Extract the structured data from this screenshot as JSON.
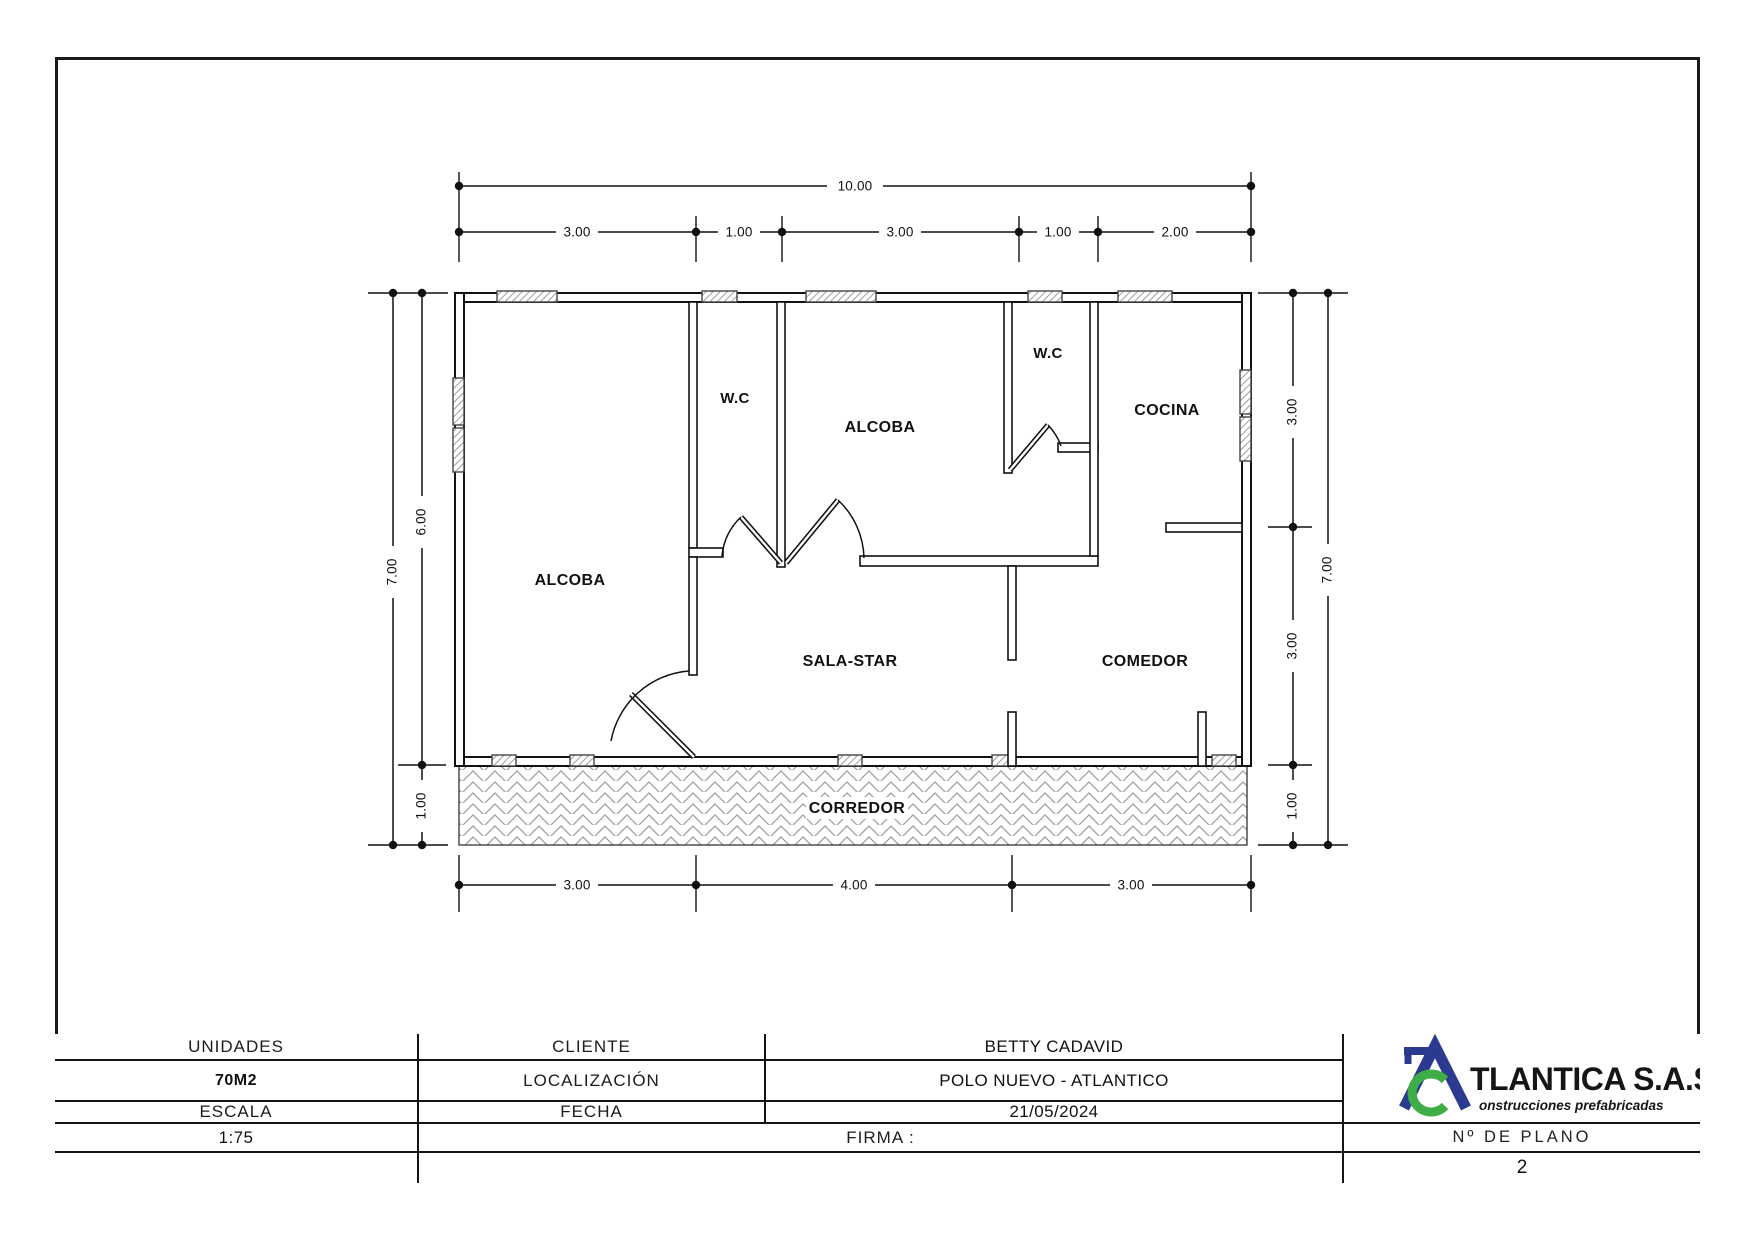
{
  "plan": {
    "rooms": [
      {
        "id": "alcoba-left",
        "label": "ALCOBA"
      },
      {
        "id": "wc-left",
        "label": "W.C"
      },
      {
        "id": "alcoba-center",
        "label": "ALCOBA"
      },
      {
        "id": "wc-right",
        "label": "W.C"
      },
      {
        "id": "cocina",
        "label": "COCINA"
      },
      {
        "id": "sala-star",
        "label": "SALA-STAR"
      },
      {
        "id": "comedor",
        "label": "COMEDOR"
      },
      {
        "id": "corredor",
        "label": "CORREDOR"
      }
    ],
    "dimensions": {
      "top_total": "10.00",
      "top_segments": [
        "3.00",
        "1.00",
        "3.00",
        "1.00",
        "2.00"
      ],
      "bottom_segments": [
        "3.00",
        "4.00",
        "3.00"
      ],
      "left_labels": [
        "7.00",
        "6.00",
        "1.00"
      ],
      "right_labels": [
        "3.00",
        "3.00",
        "1.00",
        "7.00"
      ]
    }
  },
  "title_block": {
    "unidades_label": "UNIDADES",
    "unidades_value": "70M2",
    "escala_label": "ESCALA",
    "escala_value": "1:75",
    "cliente_label": "CLIENTE",
    "cliente_value": "BETTY CADAVID",
    "localizacion_label": "LOCALIZACIÓN",
    "localizacion_value": "POLO NUEVO - ATLANTICO",
    "fecha_label": "FECHA",
    "fecha_value": "21/05/2024",
    "firma_label": "FIRMA :",
    "plano_label": "Nº DE PLANO",
    "plano_value": "2",
    "logo": {
      "main": "TLANTICA S.A.S",
      "sub": "onstrucciones prefabricadas",
      "blue": "#2b3a8f",
      "green": "#3fae49"
    }
  }
}
